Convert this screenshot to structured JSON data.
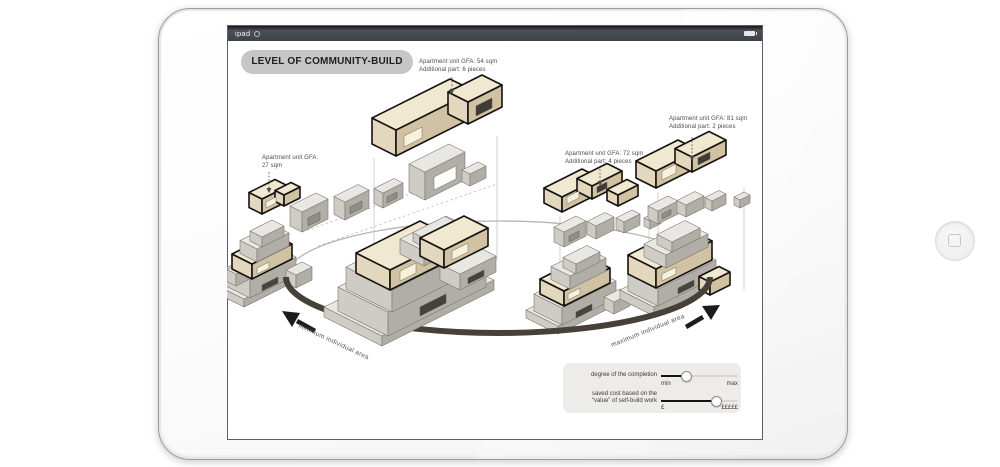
{
  "status_bar": {
    "device_label": "ipad"
  },
  "header": {
    "title": "LEVEL OF COMMUNITY-BUILD"
  },
  "annotations": {
    "unit54": {
      "line1": "Apartment unit GFA: 54 sqm",
      "line2": "Additional part: 6 pieces"
    },
    "unit27": {
      "line1": "Apartment unit GFA:",
      "line2": "27 sqm"
    },
    "unit72": {
      "line1": "Apartment unit GFA: 72 sqm",
      "line2": "Additional part: 4 pieces"
    },
    "unit81": {
      "line1": "Apartment unit GFA: 81 sqm",
      "line2": "Additional part: 2 pieces"
    }
  },
  "spectrum_labels": {
    "min_side": "minimum individual area",
    "max_side": "maximum individual area"
  },
  "controls": {
    "completion": {
      "label": "degree of the completion",
      "min_label": "min",
      "max_label": "max",
      "value_pct": 32
    },
    "saved_cost": {
      "label_line1": "saved cost based on the",
      "label_line2": "“value” of self-build work",
      "min_label": "£",
      "max_label": "£££££",
      "value_pct": 71
    }
  },
  "colors": {
    "status_bar": "#3d4247",
    "title_pill": "#c6c6c6",
    "ring_front": "#474039",
    "module_tan": "#e3d8bd",
    "module_gray": "#cfccc6",
    "highlight_outline": "#15120f"
  }
}
